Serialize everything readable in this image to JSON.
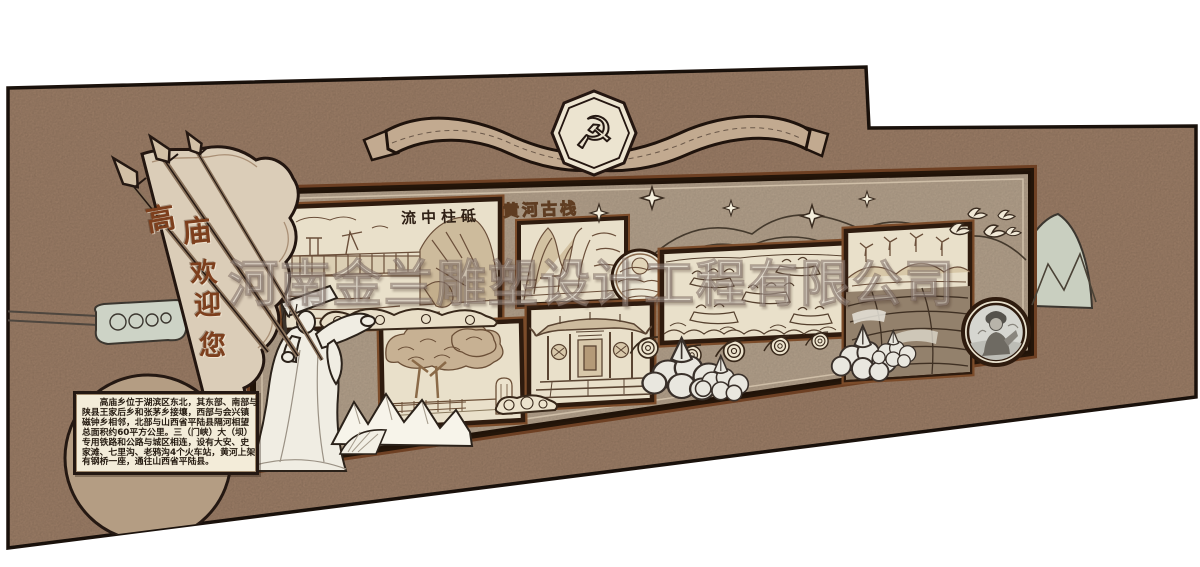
{
  "watermark": {
    "text": "河南金兰雕塑设计工程有限公司"
  },
  "emblem": {
    "glyph": "☭",
    "name": "party-emblem"
  },
  "pennant": {
    "text": "高庙欢迎您",
    "chars": [
      "高",
      "庙",
      "欢",
      "迎",
      "您"
    ]
  },
  "pictures": {
    "dam_title": "流中柱砥",
    "cliff_title": "黄河古栈"
  },
  "intro_box": {
    "lines": [
      "　　高庙乡位于湖滨区东北，其东部、南部与",
      "陕县王家后乡和张茅乡接壤，西部与会兴镇",
      "磁钟乡相邻，北部与山西省平陆县隔河相望",
      "总面积约60平方公里。三（门峡）大（坝）",
      "专用铁路和公路与城区相连，设有大安、史",
      "家滩、七里沟、老鸦沟4个火车站，黄河上架",
      "有钢桥一座，通往山西省平陆县。"
    ]
  },
  "icons": {
    "emblem": "party-emblem-icon",
    "spear": "spear-icon",
    "star": "star-icon",
    "dove": "dove-icon",
    "cloud": "cloud-scroll-icon",
    "wave": "wave-scroll-icon",
    "bush": "bush-icon"
  },
  "colors": {
    "wall": "#a3836b",
    "board": "#b7a48e",
    "frame_dark": "#2e1b0e",
    "frame_copper": "#6e4023",
    "mat_cream": "#e9e0ca",
    "sage": "#ccd2c4",
    "ink": "#241812",
    "pennant_fill": "#dbcdb8",
    "accent_text": "#7d3f1d"
  }
}
